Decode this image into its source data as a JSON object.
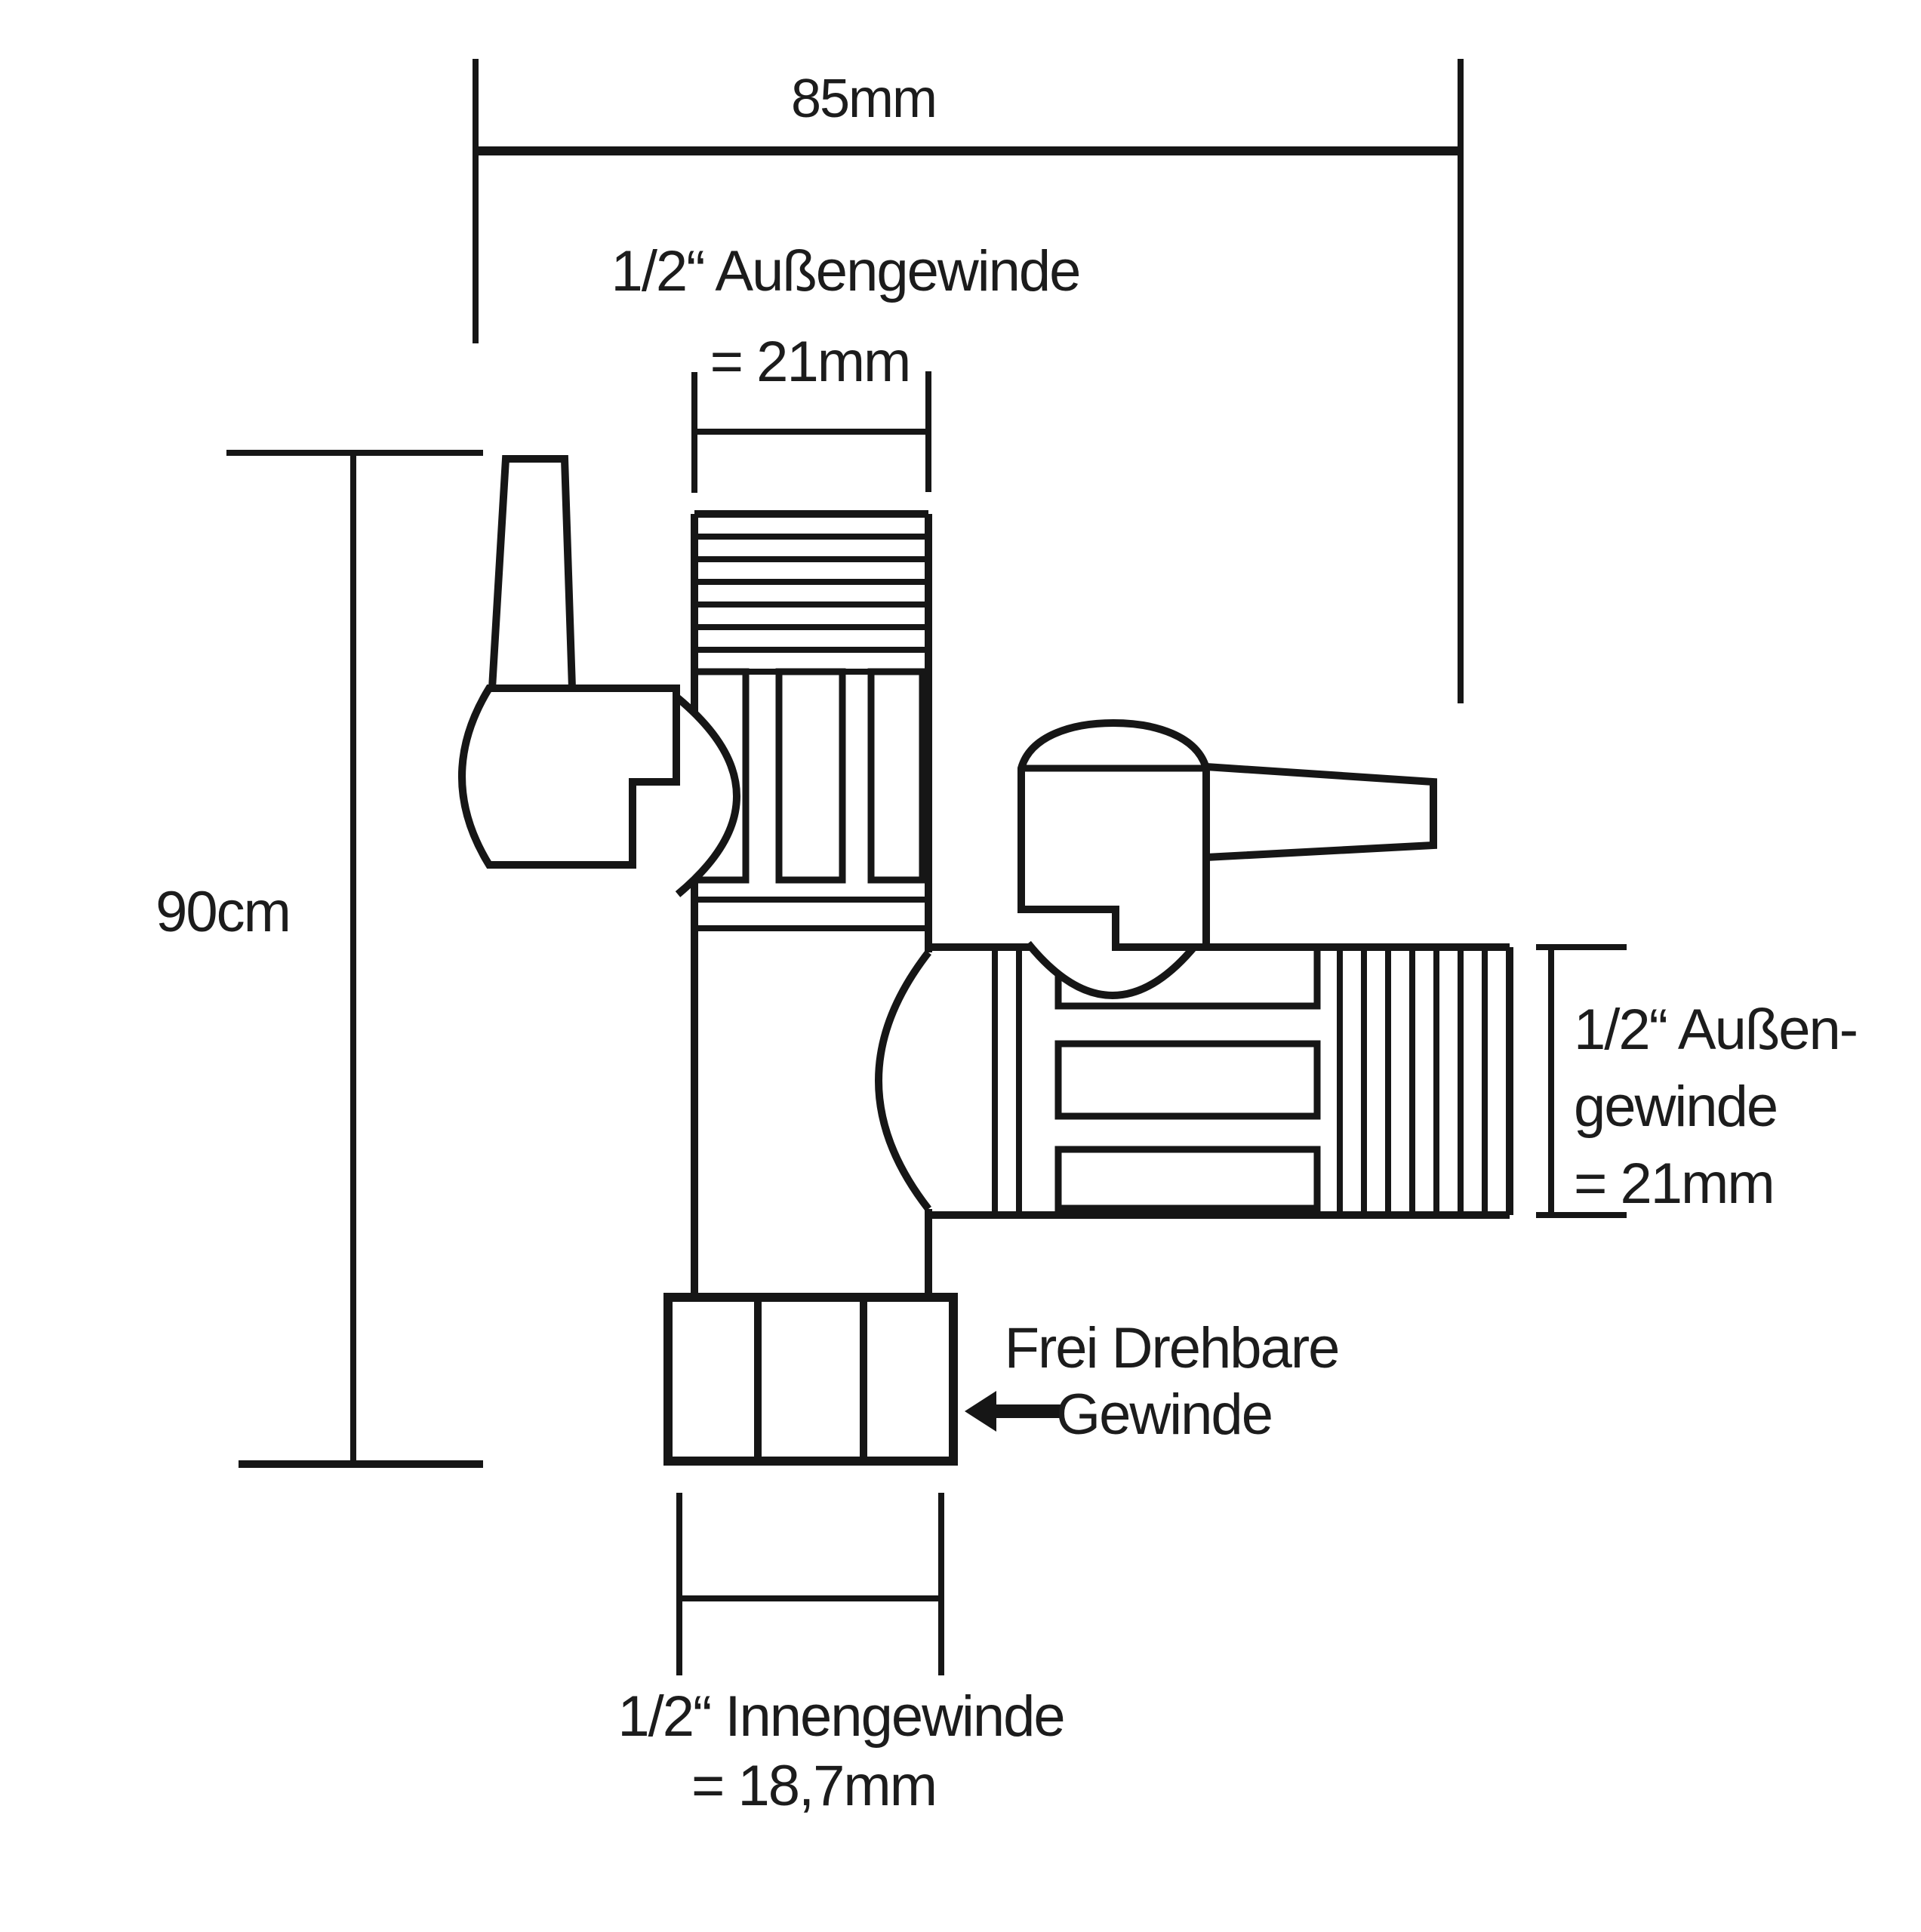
{
  "colors": {
    "background": "#ffffff",
    "line": "#161616",
    "text": "#1c1c1c"
  },
  "labels": {
    "width_top": "85mm",
    "top_thread": {
      "line1": "1/2“ Außengewinde",
      "line2": "= 21mm"
    },
    "height_left": "90cm",
    "right_thread": {
      "line1": "1/2“ Außen-",
      "line2": "gewinde",
      "line3": "= 21mm"
    },
    "swivel_note": {
      "line1": "Frei Drehbare",
      "line2": "Gewinde"
    },
    "bottom_thread": {
      "line1": "1/2“ Innengewinde",
      "line2": "= 18,7mm"
    }
  }
}
